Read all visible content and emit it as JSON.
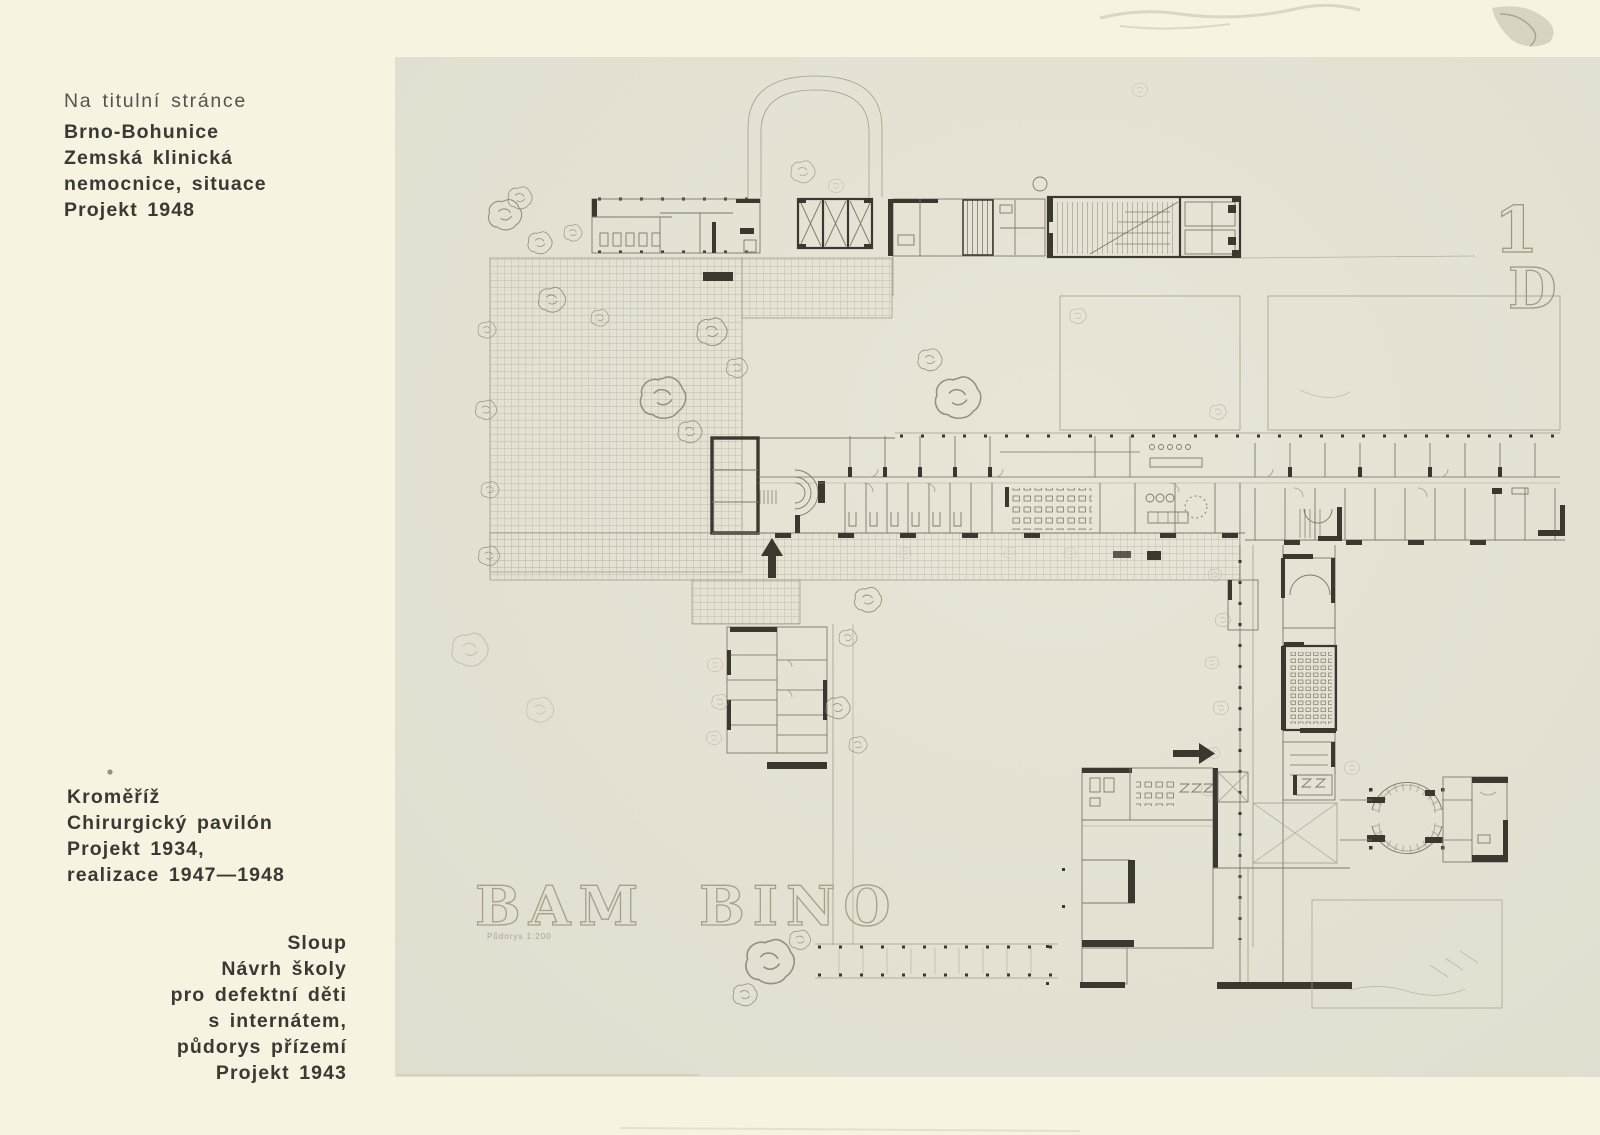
{
  "page": {
    "background": "#f7f3e1"
  },
  "captions": {
    "top_note": "Na titulní stránce",
    "top_block": [
      "Brno-Bohunice",
      "Zemská klinická",
      "nemocnice, situace",
      "Projekt 1948"
    ],
    "middle_block": [
      "Kroměříž",
      "Chirurgický pavilón",
      "Projekt 1934,",
      "realizace 1947—1948"
    ],
    "bottom_block": [
      "Sloup",
      "Návrh školy",
      "pro defektní děti",
      "s internátem,",
      "půdorys přízemí",
      "Projekt 1943"
    ]
  },
  "plate": {
    "inscription": "BAM BINO",
    "scale_note": "Půdorys 1:200",
    "figure_number": "1",
    "figure_letter": "D",
    "colors": {
      "paper": "#e5e2d4",
      "ink_light": "#8f8a7a",
      "ink_dark": "#3a382f",
      "grid": "#b4ae9c"
    }
  }
}
